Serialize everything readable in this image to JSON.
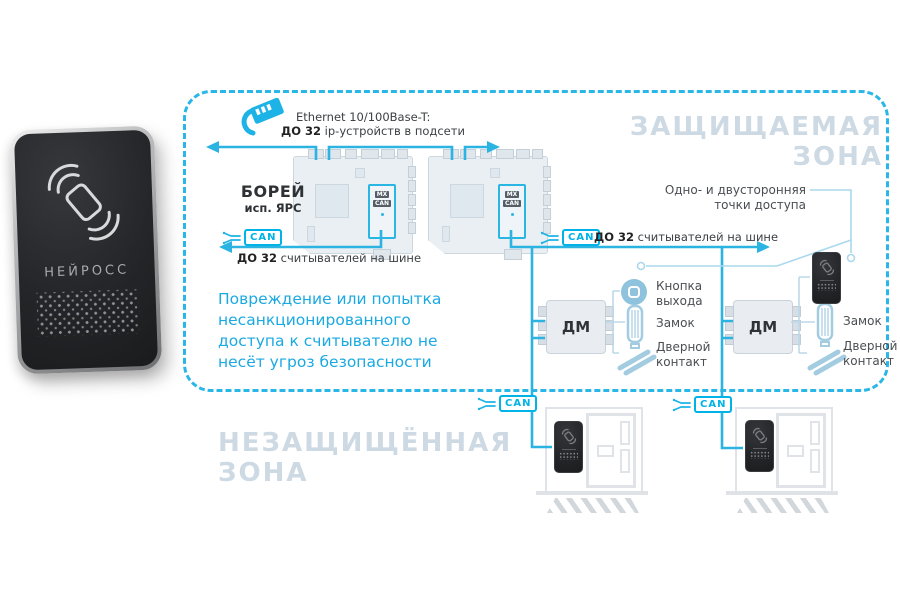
{
  "zone_protected": {
    "title": "ЗАЩИЩАЕМАЯ ЗОНА"
  },
  "zone_unprotected": {
    "line1": "НЕЗАЩИЩЁННАЯ",
    "line2": "ЗОНА"
  },
  "reader_device": {
    "brand": "НЕЙРОСС"
  },
  "ethernet": {
    "title": "Ethernet 10/100Base-T:",
    "limit_bold": "ДО 32",
    "limit_rest": " ip-устройств в подсети"
  },
  "controller": {
    "name": "БОРЕЙ",
    "variant": "исп. ЯРС",
    "chip_top": "MX",
    "chip_bottom": "CAN"
  },
  "can_bus": {
    "label": "CAN",
    "limit_bold": "ДО 32",
    "limit_rest": " считывателей на шине"
  },
  "warning": {
    "lines": [
      "Повреждение или попытка",
      "несанкционированного",
      "доступа к считывателю не",
      "несёт угроз безопасности"
    ]
  },
  "access_points": {
    "line1": "Одно- и двусторонняя",
    "line2": "точки доступа"
  },
  "door_module": {
    "label": "ДМ"
  },
  "peripherals": {
    "exit_button_l1": "Кнопка",
    "exit_button_l2": "выхода",
    "lock": "Замок",
    "door_contact_l1": "Дверной",
    "door_contact_l2": "контакт"
  },
  "colors": {
    "accent": "#1db1e4",
    "zone_title": "#cdd9e3",
    "warning_text": "#1ba9e1",
    "light_line": "#aad8ec",
    "icon_blue": "#9cc8de"
  }
}
